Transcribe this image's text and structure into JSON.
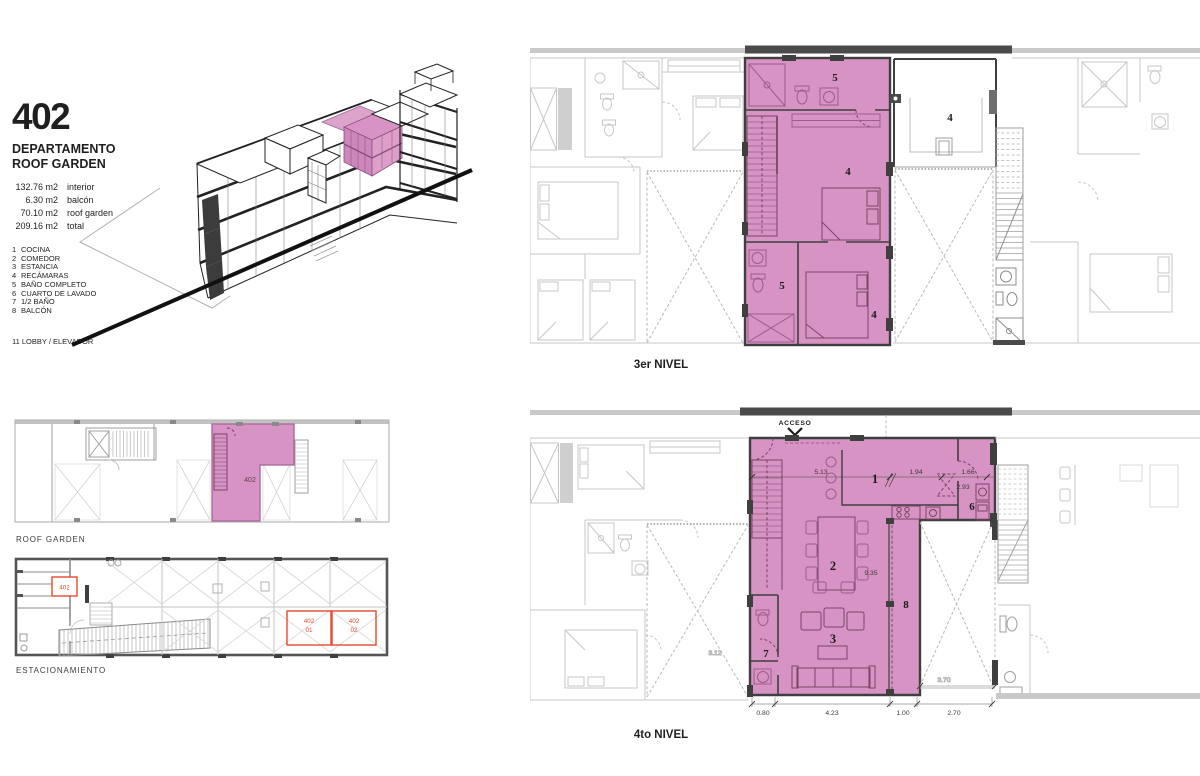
{
  "colors": {
    "highlight_pink": "#d793c3",
    "pink_line": "#9c5d8c",
    "pink_dark": "#7a4467",
    "wall_dark": "#3f3f3f",
    "line_gray": "#c2c2c2",
    "accent_red": "#e8492f",
    "text_dark": "#1f1f1f"
  },
  "info": {
    "unit_number": "402",
    "title_line1": "DEPARTAMENTO",
    "title_line2": "ROOF GARDEN",
    "areas": [
      {
        "value": "132.76 m2",
        "label": "interior"
      },
      {
        "value": "6.30 m2",
        "label": "balcón"
      },
      {
        "value": "70.10 m2",
        "label": "roof garden"
      },
      {
        "value": "209.16 m2",
        "label": "total"
      }
    ],
    "legend": [
      {
        "num": "1",
        "label": "COCINA"
      },
      {
        "num": "2",
        "label": "COMEDOR"
      },
      {
        "num": "3",
        "label": "ESTANCIA"
      },
      {
        "num": "4",
        "label": "RECÁMARAS"
      },
      {
        "num": "5",
        "label": "BAÑO COMPLETO"
      },
      {
        "num": "6",
        "label": "CUARTO DE LAVADO"
      },
      {
        "num": "7",
        "label": "1/2 BAÑO"
      },
      {
        "num": "8",
        "label": "BALCÓN"
      }
    ],
    "lobby_note": "11 LOBBY / ELEVADOR"
  },
  "plans": {
    "level3": {
      "label": "3er NIVEL",
      "rooms": {
        "bath_top": "5",
        "bedroom_top": "4",
        "bath_lower": "5",
        "bedroom_lower": "4",
        "terrace": "4"
      }
    },
    "level4": {
      "label": "4to NIVEL",
      "acceso": "ACCESO",
      "rooms": {
        "kitchen": "1",
        "dining": "2",
        "living": "3",
        "laundry": "6",
        "half_bath": "7",
        "balcony": "8"
      },
      "dims": {
        "d513": "5.13",
        "d194": "1.94",
        "d166": "1.66",
        "d293": "2.93",
        "d935": "9.35",
        "d312": "3.12",
        "d370": "3.70",
        "d080": "0.80",
        "d423": "4.23",
        "d100": "1.00",
        "d270": "2.70"
      }
    },
    "roof_garden": {
      "label": "ROOF GARDEN",
      "unit_label": "402"
    },
    "parking": {
      "label": "ESTACIONAMIENTO",
      "storage_label": "402",
      "space1_line1": "402",
      "space1_line2": "01",
      "space2_line1": "402",
      "space2_line2": "02"
    }
  }
}
